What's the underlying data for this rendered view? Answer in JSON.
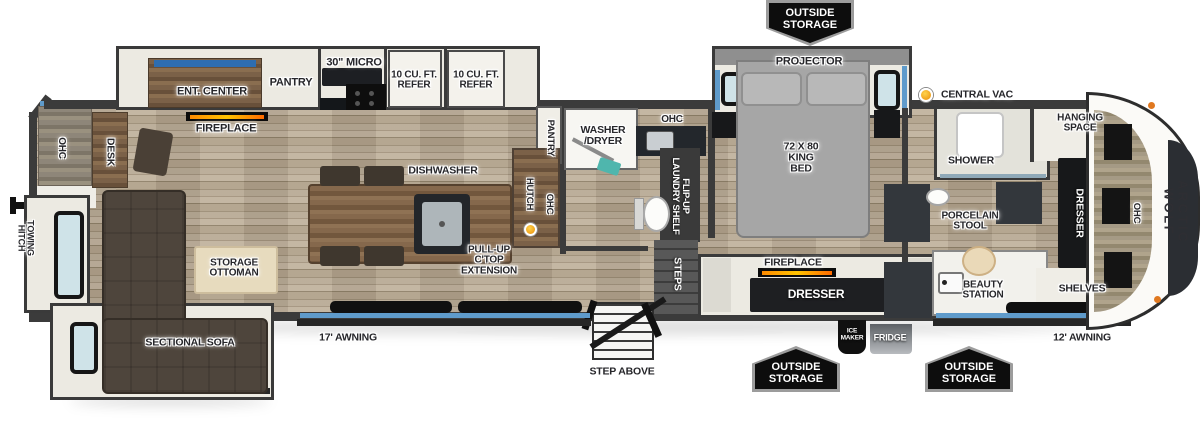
{
  "colors": {
    "wall": "#3b3b3b",
    "floor": "#b3a48e",
    "accent_blue": "#5f9bcb",
    "badge_black": "#0d0d0d",
    "vac_dot_orange": "#f0a11c",
    "sofa_brown": "#4e453c",
    "flame_orange": "#ff8a00"
  },
  "labels": [
    {
      "id": "ohc-rear",
      "t": "OHC",
      "x": 61,
      "y": 148,
      "r": 90,
      "fs": 10
    },
    {
      "id": "desk",
      "t": "DESK",
      "x": 110,
      "y": 152,
      "r": 90,
      "fs": 10.5
    },
    {
      "id": "towing-hitch",
      "t": "TOWING\nHITCH",
      "x": 25,
      "y": 238,
      "r": 90,
      "fs": 9
    },
    {
      "id": "ent-center",
      "t": "ENT. CENTER",
      "x": 212,
      "y": 92,
      "fs": 11
    },
    {
      "id": "pantry-kitchen",
      "t": "PANTRY",
      "x": 291,
      "y": 83,
      "fs": 11
    },
    {
      "id": "micro-30",
      "t": "30\" MICRO",
      "x": 354,
      "y": 63,
      "fs": 11
    },
    {
      "id": "refer-1",
      "t": "10 CU. FT.\nREFER",
      "x": 414,
      "y": 81,
      "fs": 10
    },
    {
      "id": "refer-2",
      "t": "10 CU. FT.\nREFER",
      "x": 476,
      "y": 81,
      "fs": 10
    },
    {
      "id": "fireplace-living",
      "t": "FIREPLACE",
      "x": 226,
      "y": 129,
      "fs": 11
    },
    {
      "id": "dishwasher",
      "t": "DISHWASHER",
      "x": 443,
      "y": 171,
      "fs": 10.5
    },
    {
      "id": "pullup-ctop",
      "t": "PULL-UP\nC'TOP\nEXTENSION",
      "x": 489,
      "y": 261,
      "fs": 10
    },
    {
      "id": "storage-ottoman",
      "t": "STORAGE\nOTTOMAN",
      "x": 234,
      "y": 269,
      "fs": 10
    },
    {
      "id": "sectional-sofa",
      "t": "SECTIONAL SOFA",
      "x": 190,
      "y": 343,
      "fs": 10.5
    },
    {
      "id": "awning-17",
      "t": "17' AWNING",
      "x": 348,
      "y": 338,
      "fs": 10.5
    },
    {
      "id": "pantry-mid",
      "t": "PANTRY",
      "x": 550,
      "y": 138,
      "r": 90,
      "fs": 9.5
    },
    {
      "id": "hutch",
      "t": "HUTCH",
      "x": 529,
      "y": 194,
      "r": 90,
      "fs": 9.5
    },
    {
      "id": "ohc-hutch",
      "t": "OHC",
      "x": 549,
      "y": 204,
      "r": 90,
      "fs": 9.5
    },
    {
      "id": "washer-dryer",
      "t": "WASHER\n/DRYER",
      "x": 603,
      "y": 136,
      "fs": 10.5
    },
    {
      "id": "ohc-bath",
      "t": "OHC",
      "x": 672,
      "y": 120,
      "fs": 10
    },
    {
      "id": "flipup-laundry",
      "t": "FLIP-UP\nLAUNDRY SHELF",
      "x": 680,
      "y": 196,
      "r": 90,
      "c": "w",
      "fs": 9.5
    },
    {
      "id": "steps",
      "t": "STEPS",
      "x": 677,
      "y": 274,
      "r": 90,
      "c": "w",
      "fs": 10.5
    },
    {
      "id": "step-above",
      "t": "STEP ABOVE",
      "x": 622,
      "y": 372,
      "fs": 10.5
    },
    {
      "id": "projector",
      "t": "PROJECTOR",
      "x": 809,
      "y": 62,
      "fs": 11
    },
    {
      "id": "king-bed",
      "t": "72 X 80\nKING\nBED",
      "x": 801,
      "y": 158,
      "fs": 10.5
    },
    {
      "id": "fireplace-bedroom",
      "t": "FIREPLACE",
      "x": 793,
      "y": 263,
      "fs": 10.5
    },
    {
      "id": "dresser-bedroom",
      "t": "DRESSER",
      "x": 816,
      "y": 294,
      "c": "w",
      "fs": 12
    },
    {
      "id": "ice-maker",
      "t": "ICE\nMAKER",
      "x": 852,
      "y": 335,
      "c": "w",
      "fs": 6.5
    },
    {
      "id": "fridge",
      "t": "FRIDGE",
      "x": 890,
      "y": 338,
      "c": "w",
      "fs": 9
    },
    {
      "id": "central-vac",
      "t": "CENTRAL VAC",
      "x": 977,
      "y": 95,
      "fs": 10.5
    },
    {
      "id": "shower",
      "t": "SHOWER",
      "x": 971,
      "y": 161,
      "fs": 10.5
    },
    {
      "id": "porcelain-stool",
      "t": "PORCELAIN\nSTOOL",
      "x": 970,
      "y": 222,
      "fs": 10
    },
    {
      "id": "beauty-station",
      "t": "BEAUTY\nSTATION",
      "x": 983,
      "y": 291,
      "fs": 10
    },
    {
      "id": "hanging-space",
      "t": "HANGING\nSPACE",
      "x": 1080,
      "y": 124,
      "fs": 10
    },
    {
      "id": "dresser-front",
      "t": "DRESSER",
      "x": 1079,
      "y": 213,
      "r": 90,
      "c": "w",
      "fs": 10.5
    },
    {
      "id": "ohc-front",
      "t": "OHC",
      "x": 1136,
      "y": 213,
      "r": 90,
      "fs": 9.5
    },
    {
      "id": "shelves",
      "t": "SHELVES",
      "x": 1082,
      "y": 289,
      "fs": 10.5
    },
    {
      "id": "awning-12",
      "t": "12' AWNING",
      "x": 1082,
      "y": 338,
      "fs": 10.5
    },
    {
      "id": "arctic-wolf",
      "t": "ARCTIC WOLF",
      "x": 1176,
      "y": 212,
      "r": 90,
      "c": "cap",
      "fs": 13,
      "ls": 2.5
    }
  ],
  "badges": [
    {
      "id": "outside-storage-top",
      "t": "OUTSIDE\nSTORAGE",
      "x": 810,
      "y": 23,
      "dir": "down"
    },
    {
      "id": "outside-storage-bottom-1",
      "t": "OUTSIDE\nSTORAGE",
      "x": 796,
      "y": 369,
      "dir": "up"
    },
    {
      "id": "outside-storage-bottom-2",
      "t": "OUTSIDE\nSTORAGE",
      "x": 969,
      "y": 369,
      "dir": "up"
    }
  ],
  "dots": [
    {
      "id": "central-vac-dot",
      "x": 919,
      "y": 88,
      "s": 14
    },
    {
      "id": "vac-inlet-dot",
      "x": 524,
      "y": 223,
      "s": 13
    }
  ]
}
